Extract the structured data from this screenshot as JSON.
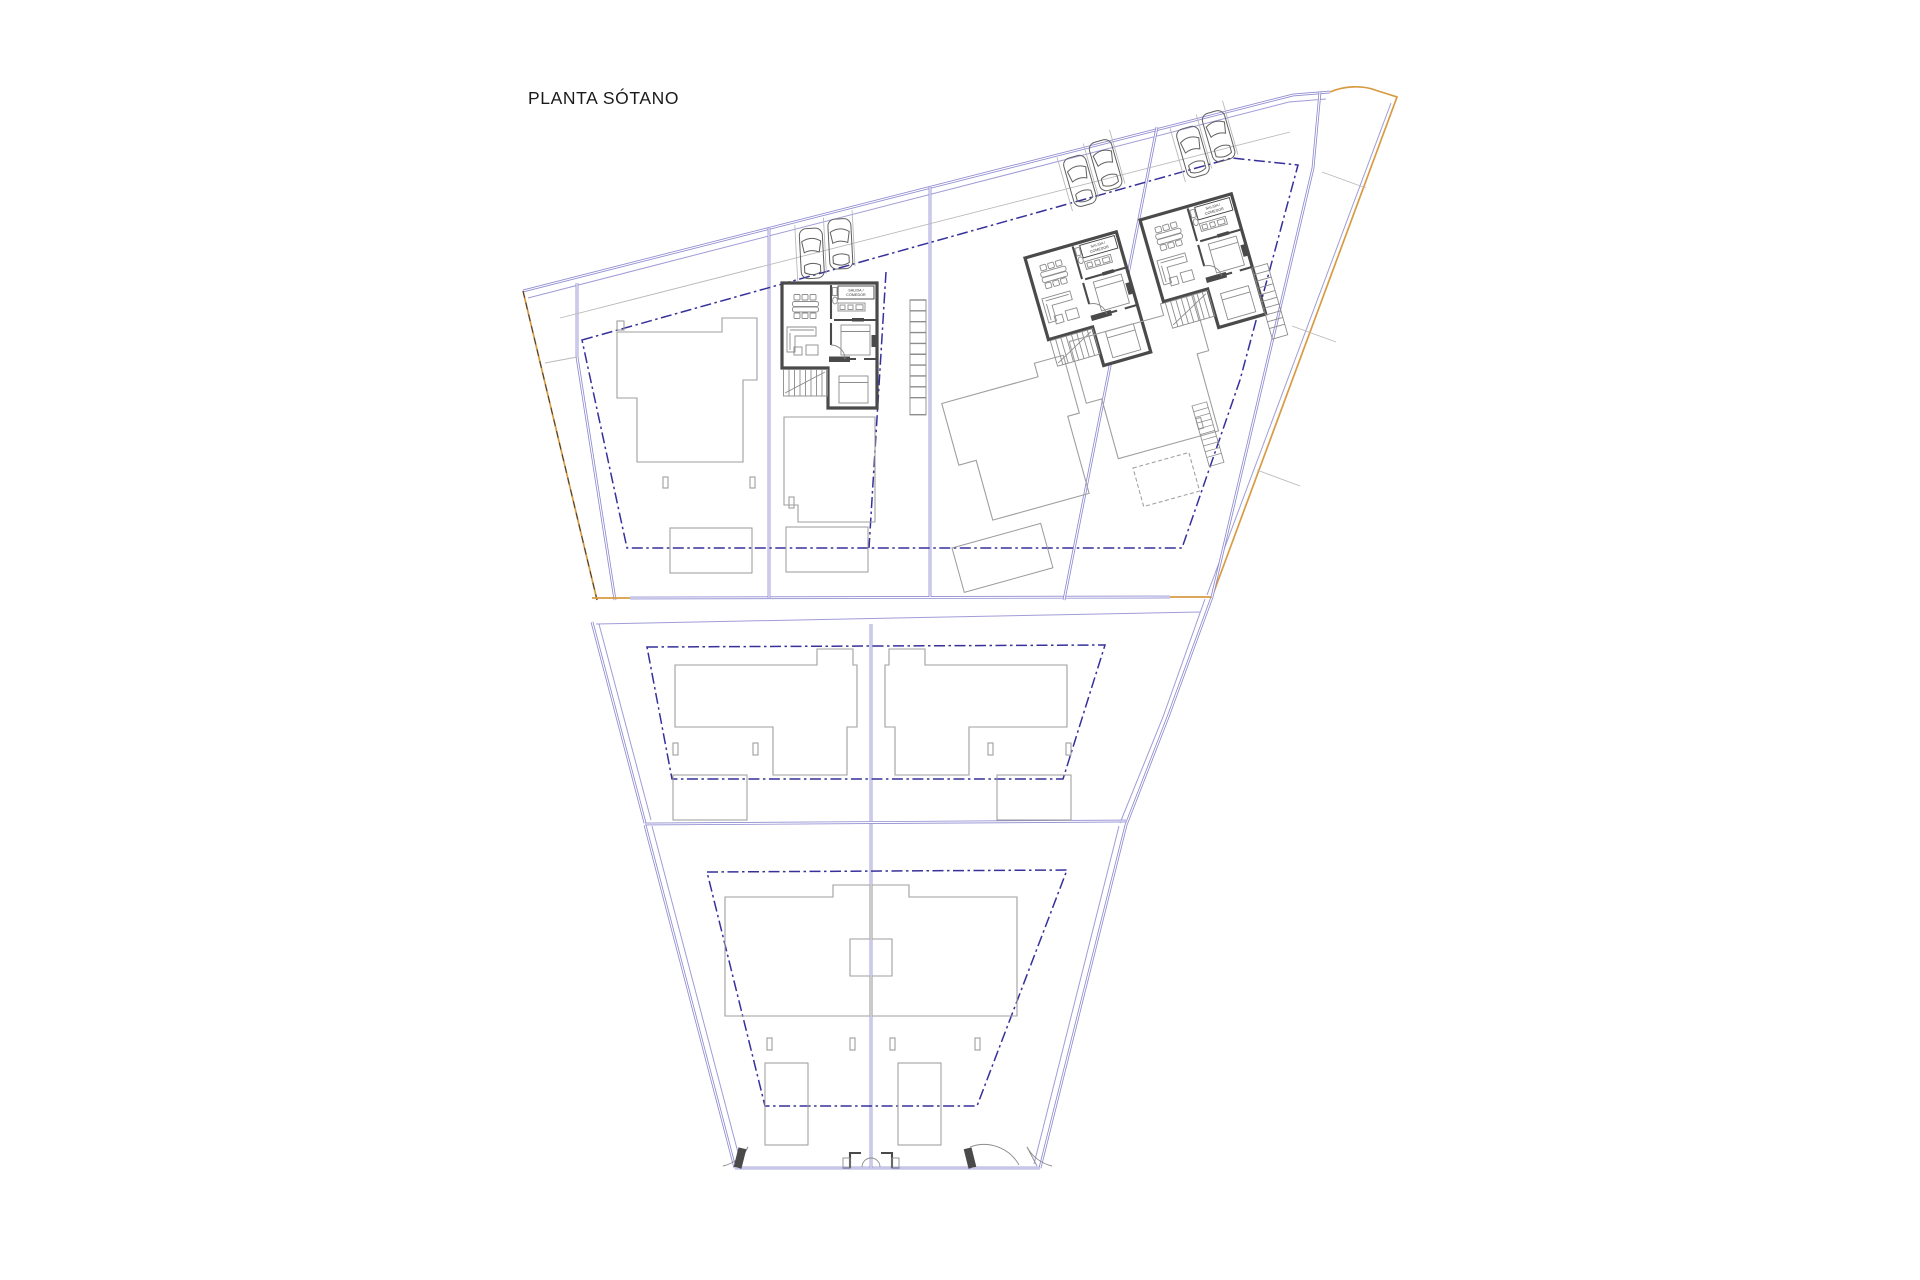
{
  "title": "PLANTA SÓTANO",
  "unit_plan": {
    "label_line1": "SALIDA /",
    "label_line2": "COMEDOR"
  },
  "colors": {
    "background": "#ffffff",
    "text": "#1a1a1a",
    "orange": "#d89b44",
    "purple": "#8f8bd0",
    "dashdot": "#36309b",
    "wall": "#4a4a4a",
    "house": "#9f9f9f",
    "gray": "#b9b9b9",
    "thin": "#8c8c8c",
    "car": "#5f5f5f"
  }
}
